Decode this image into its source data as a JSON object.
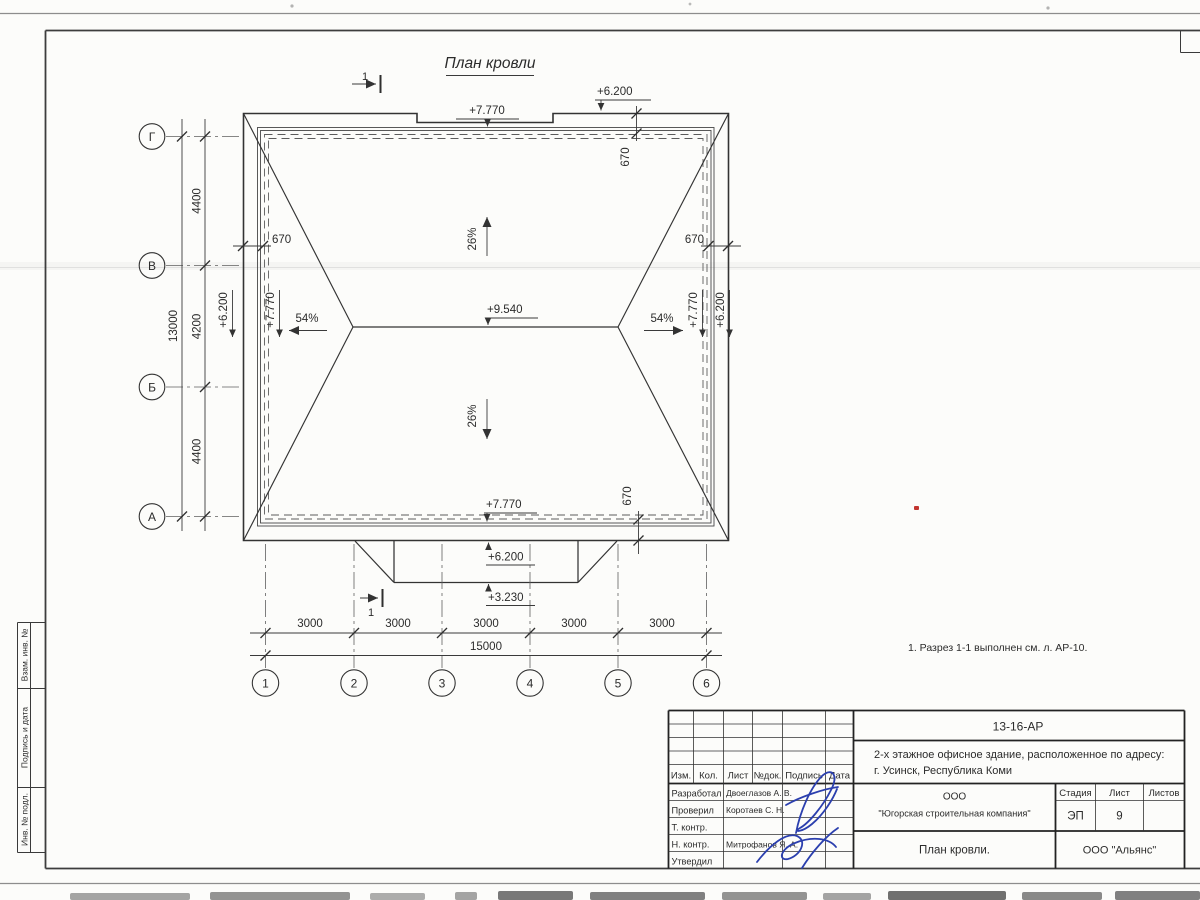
{
  "sheet": {
    "drawing_title": "План кровли",
    "note": "1. Разрез 1-1 выполнен см. л. АР-10.",
    "section_label": "1"
  },
  "plan": {
    "slope_main": "26%",
    "slope_side": "54%",
    "elev_ridge": "+9.540",
    "elev_eave": "+7.770",
    "elev_canopy": "+6.200",
    "elev_canopy_edge": "+3.230",
    "overhang": "670",
    "axes_letters": [
      "Г",
      "В",
      "Б",
      "А"
    ],
    "axes_numbers": [
      "1",
      "2",
      "3",
      "4",
      "5",
      "6"
    ],
    "dims_left": [
      "4400",
      "4200",
      "4400"
    ],
    "dim_left_total": "13000",
    "dims_bottom": [
      "3000",
      "3000",
      "3000",
      "3000",
      "3000"
    ],
    "dim_bottom_total": "15000"
  },
  "title_block": {
    "doc_number": "13-16-АР",
    "project_line1": "2-х этажное офисное здание, расположенное по адресу:",
    "project_line2": "г. Усинск, Республика Коми",
    "col_izm": "Изм.",
    "col_kol": "Кол.",
    "col_list": "Лист",
    "col_ndok": "№док.",
    "col_podpis": "Подпись",
    "col_data": "Дата",
    "role_developed": "Разработал",
    "role_checked": "Проверил",
    "role_tcontrol": "Т. контр.",
    "role_ncontrol": "Н. контр.",
    "role_approved": "Утвердил",
    "name_developed": "Двоеглазов А. В.",
    "name_checked": "Коротаев С. Н.",
    "name_ncontrol": "Митрофанов Я. А.",
    "company_line1": "ООО",
    "company_line2": "\"Югорская строительная компания\"",
    "stage_label": "Стадия",
    "sheet_label": "Лист",
    "sheets_label": "Листов",
    "stage_value": "ЭП",
    "sheet_value": "9",
    "drawing_name": "План кровли.",
    "org_name": "ООО \"Альянс\""
  },
  "side_strip": {
    "box1": "Взам. инв. №",
    "box2": "Подпись и дата",
    "box3": "Инв. № подл."
  }
}
